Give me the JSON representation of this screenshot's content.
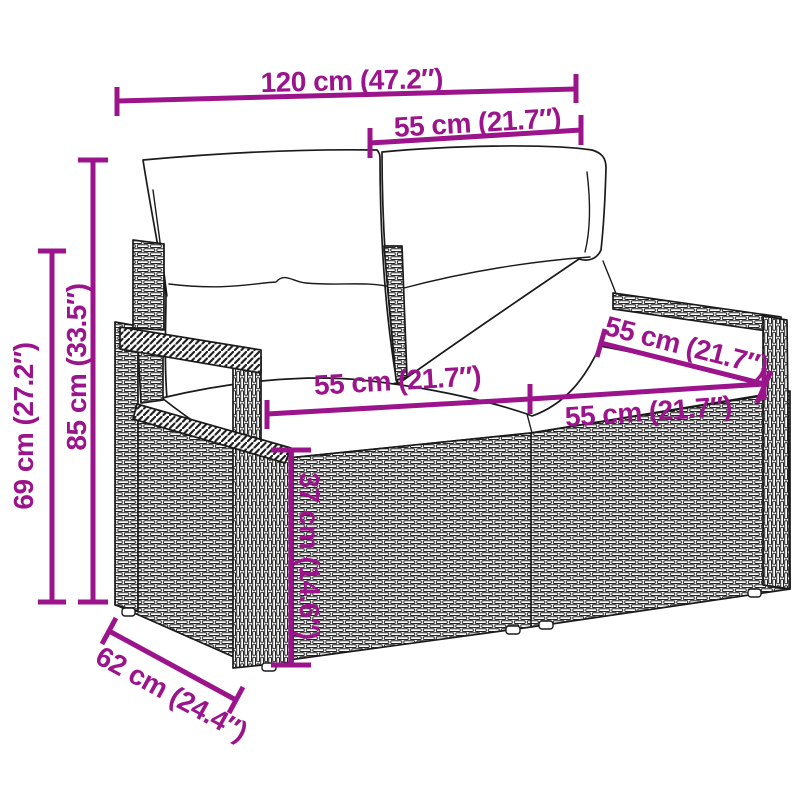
{
  "figure": {
    "type": "product-dimension-diagram",
    "product": "poly rattan 2-seater garden sofa with back and seat cushions",
    "style": "black line-art sketch on white background with magenta dimension annotations"
  },
  "colors": {
    "dimension_accent": "#9B148B",
    "line_art": "#1B1B1B",
    "background": "#FFFFFF"
  },
  "dimensions": {
    "overall_width": {
      "label": "120 cm (47.2″)"
    },
    "back_section_width": {
      "label": "55 cm (21.7″)"
    },
    "overall_height": {
      "label": "85 cm (33.5″)"
    },
    "arm_height": {
      "label": "69 cm (27.2″)"
    },
    "seat_width_left": {
      "label": "55 cm (21.7″)"
    },
    "seat_width_right": {
      "label": "55 cm (21.7″)"
    },
    "seat_depth_right": {
      "label": "55 cm (21.7″)"
    },
    "seat_height": {
      "label": "37 cm (14.6″)"
    },
    "overall_depth": {
      "label": "62 cm (24.4″)"
    }
  }
}
